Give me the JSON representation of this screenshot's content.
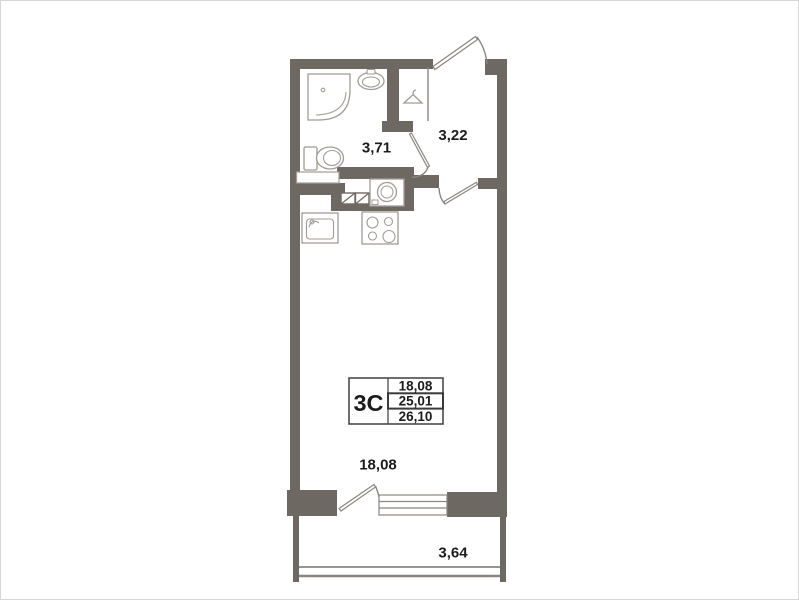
{
  "plan": {
    "labels": {
      "bathroom_area": "3,71",
      "hallway_area": "3,22",
      "room_area": "18,08",
      "balcony_area": "3,64"
    },
    "info_table": {
      "unit_label": "3С",
      "rows": [
        "18,08",
        "25,01",
        "26,10"
      ]
    },
    "colors": {
      "wall": "#6e6862",
      "door_window_line": "#8a8580",
      "fixture_line": "#a09b95",
      "text": "#1c1c1c"
    }
  }
}
